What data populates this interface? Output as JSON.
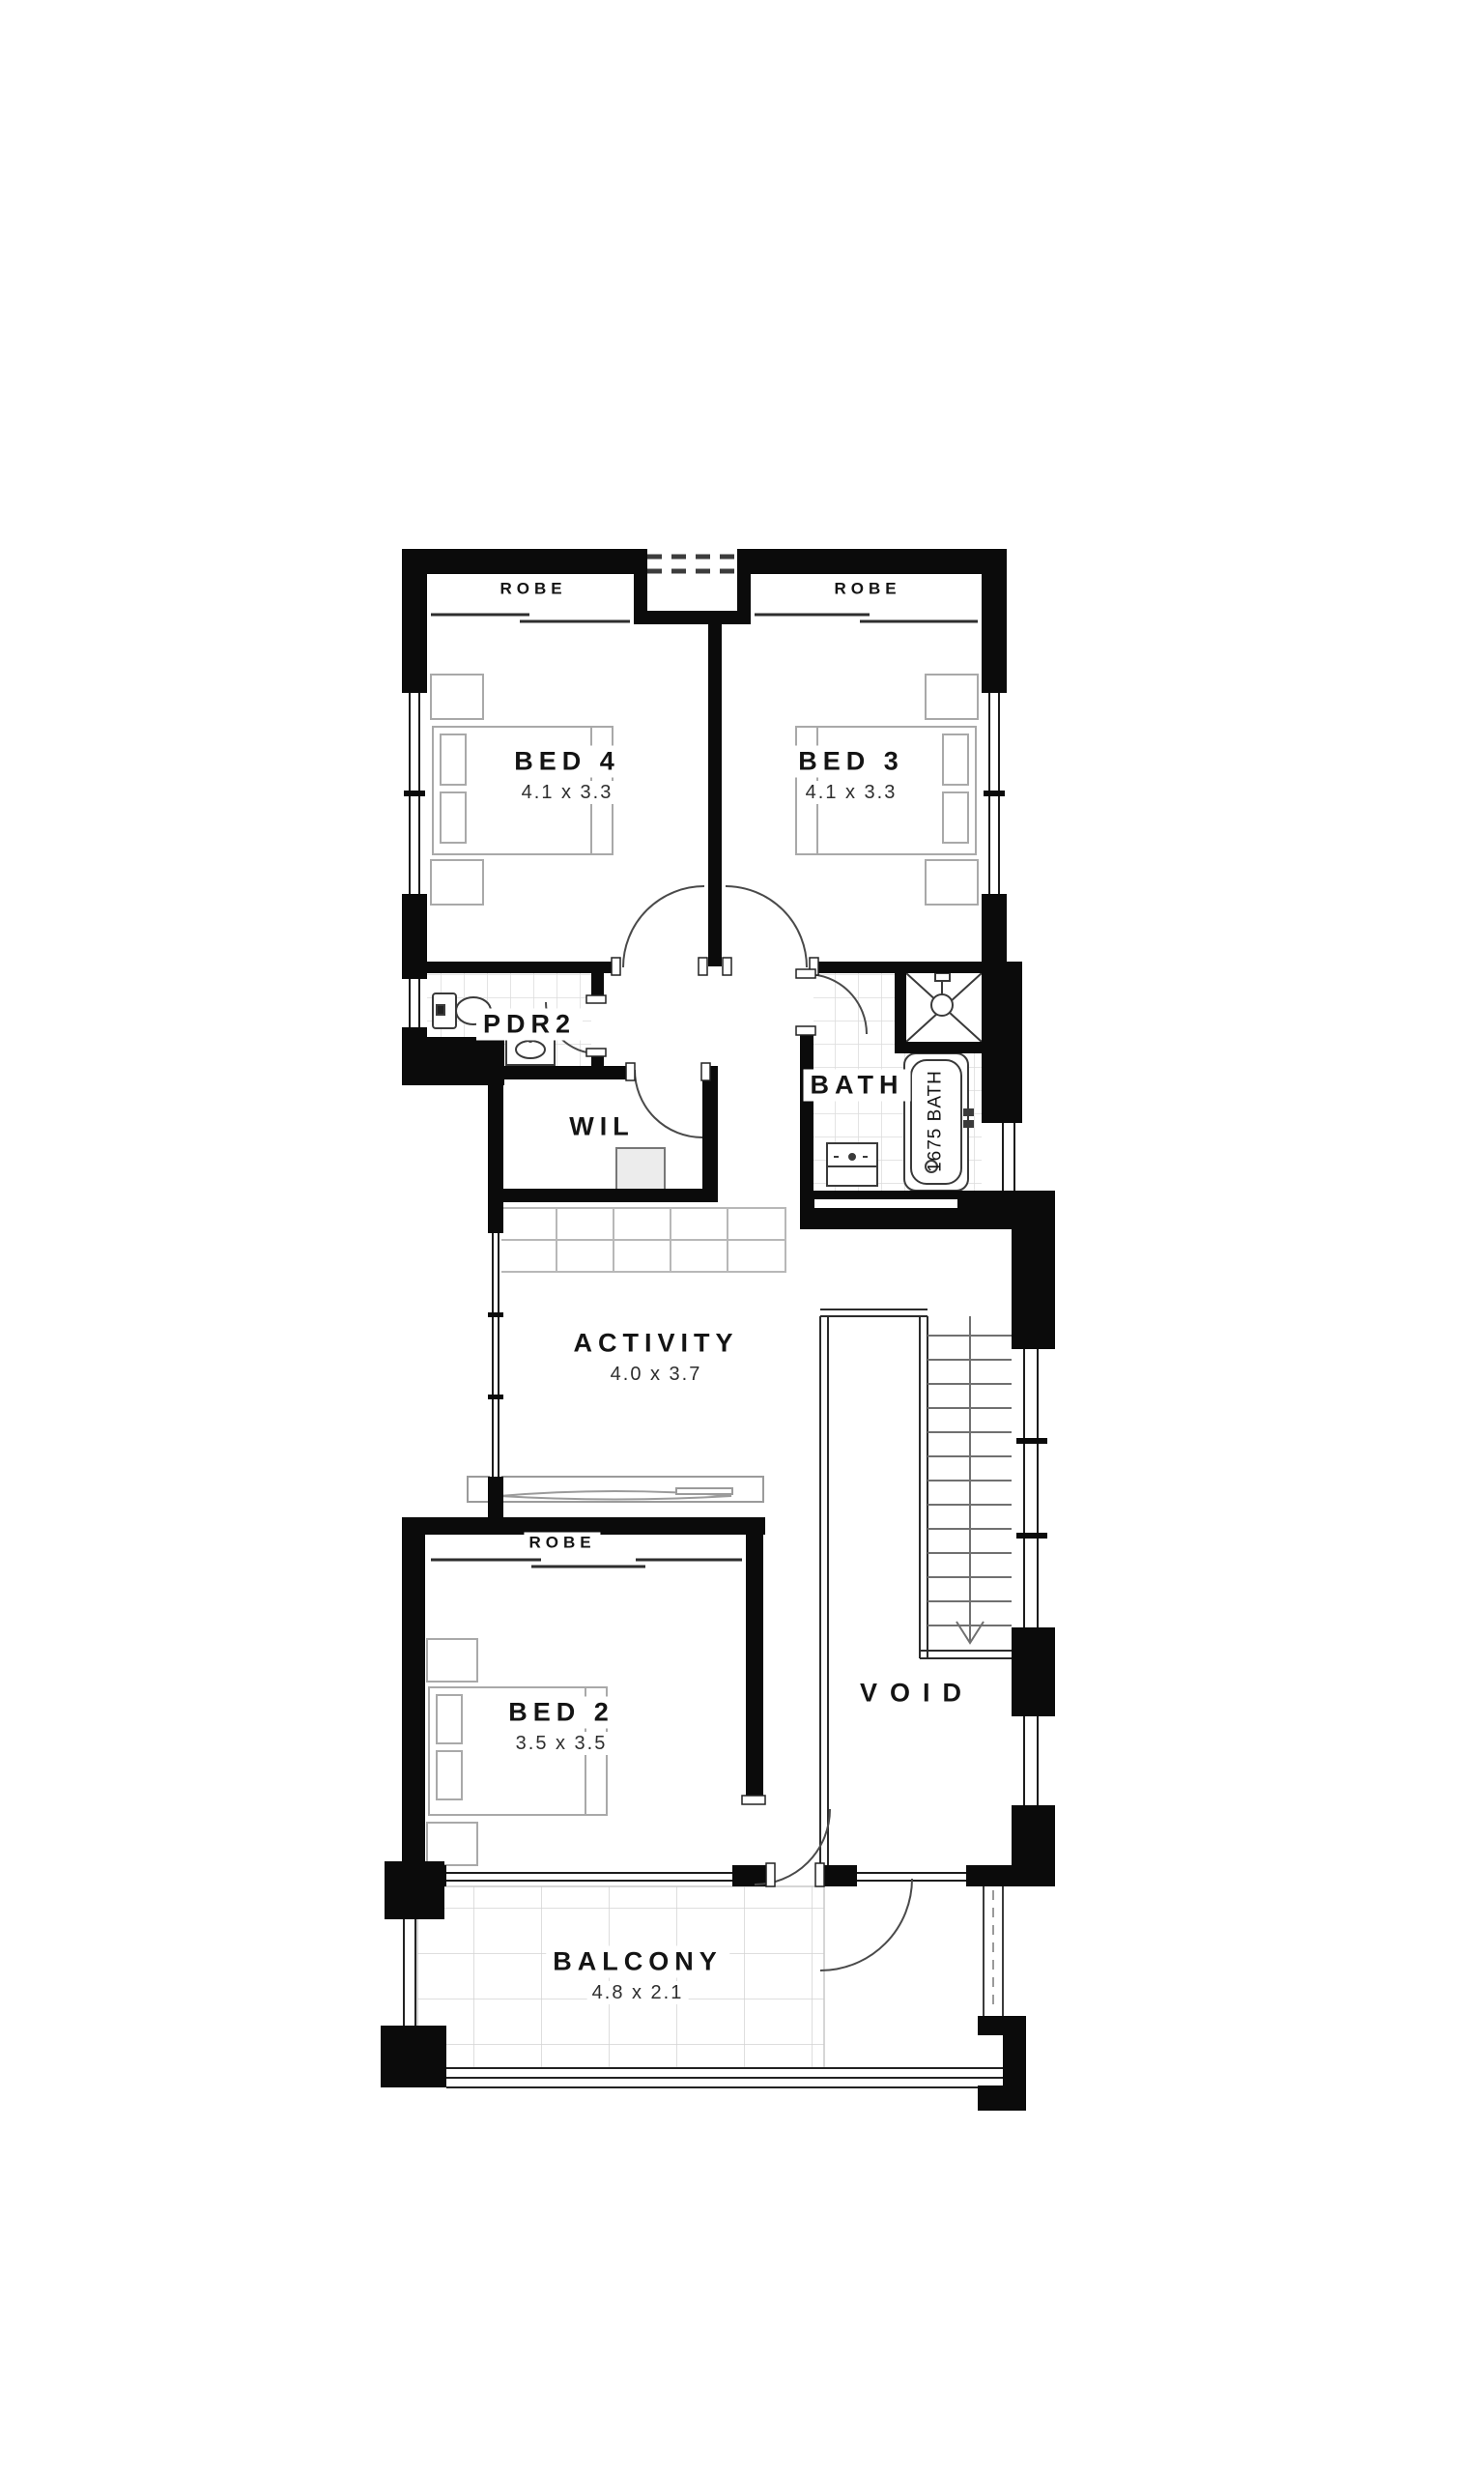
{
  "plan": {
    "rooms": {
      "bed4": {
        "label": "BED 4",
        "dims": "4.1 x 3.3"
      },
      "bed3": {
        "label": "BED 3",
        "dims": "4.1 x 3.3"
      },
      "bed2": {
        "label": "BED 2",
        "dims": "3.5 x 3.5"
      },
      "activity": {
        "label": "ACTIVITY",
        "dims": "4.0 x 3.7"
      },
      "balcony": {
        "label": "BALCONY",
        "dims": "4.8 x 2.1"
      },
      "pdr2": {
        "label": "PDR2"
      },
      "wil": {
        "label": "WIL"
      },
      "bath": {
        "label": "BATH"
      },
      "void": {
        "label": "VOID"
      }
    },
    "robes": {
      "bed4": "ROBE",
      "bed3": "ROBE",
      "bed2": "ROBE"
    },
    "fixtures": {
      "bath_tub": "1675 BATH"
    },
    "colors": {
      "wall": "#0b0b0b",
      "background": "#ffffff",
      "furniture_line": "#a9a9a9",
      "tile_line": "#dcdcdc"
    }
  }
}
